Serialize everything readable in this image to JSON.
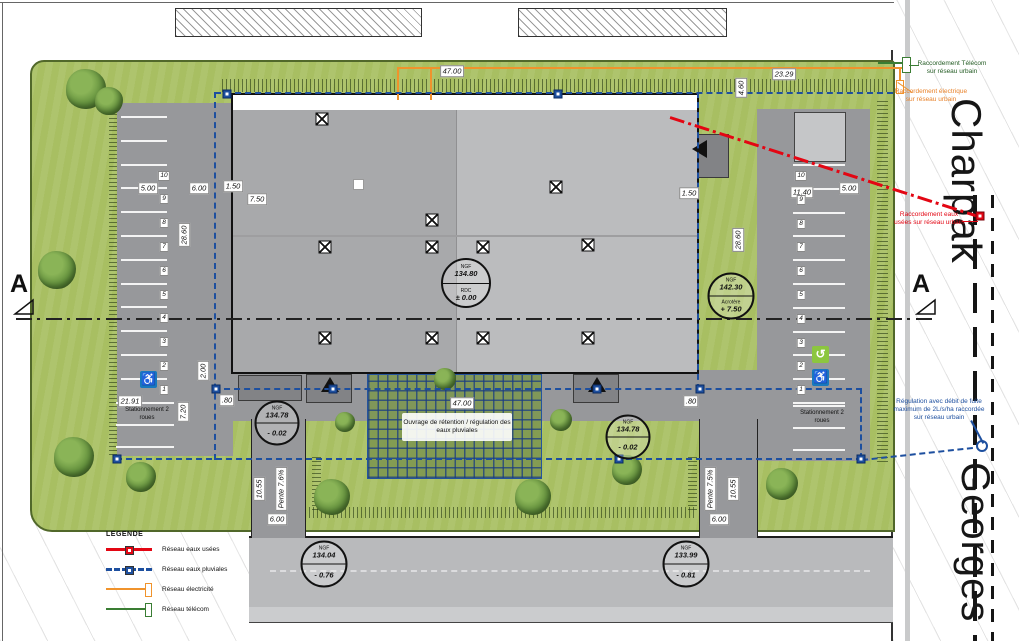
{
  "streets": {
    "main": "Charpak",
    "secondary": "Georges"
  },
  "section": {
    "label": "A"
  },
  "legend": {
    "title": "LEGENDE",
    "items": [
      {
        "label": "Réseau eaux usées"
      },
      {
        "label": "Réseau eaux pluviales"
      },
      {
        "label": "Réseau électricité"
      },
      {
        "label": "Réseau télécom"
      }
    ]
  },
  "annotations": {
    "telecom": "Raccordement Télécom sur réseau urbain",
    "electricite": "Raccordement électrique sur réseau urbain",
    "eaux_usees": "Raccordement eaux usées sur réseau urbain",
    "regulation": "Régulation avec débit de fuite maximum de 2L/s/ha raccordée sur réseau urbain",
    "retention": "Ouvrage de rétention / régulation des eaux pluviales"
  },
  "levels": {
    "rdc": {
      "ref": "NGF",
      "altitude": "134.80",
      "label": "RDC",
      "value": "± 0.00"
    },
    "acrotere": {
      "ref": "NGF",
      "altitude": "142.30",
      "label": "Acrotère",
      "value": "+ 7.50"
    },
    "parvis_ouest": {
      "ref": "NGF",
      "altitude": "134.78",
      "label": "",
      "value": "- 0.02"
    },
    "parvis_est": {
      "ref": "NGF",
      "altitude": "134.78",
      "label": "",
      "value": "- 0.02"
    },
    "voirie_ouest": {
      "ref": "NGF",
      "altitude": "134.04",
      "label": "",
      "value": "- 0.76"
    },
    "voirie_est": {
      "ref": "NGF",
      "altitude": "133.99",
      "label": "",
      "value": "- 0.81"
    }
  },
  "dimensions": {
    "building_width": "47.00",
    "north_east_width": "23.29",
    "north_east_depth": "4.60",
    "west_stall": "5.00",
    "west_aisle": "6.00",
    "west_strip": "1.50",
    "west_setback": "7.50",
    "west_length": "28.60",
    "east_strip": "1.50",
    "east_aisle": "11.40",
    "east_stall": "5.00",
    "east_length": "28.60",
    "south_width": "21.91",
    "south_depth": "7.20",
    "south_gap_west": ".80",
    "south_offset": "2.00",
    "south_gap_east": ".80",
    "retention_width": "47.00",
    "access_west_width": "6.00",
    "access_west_length": "10.55",
    "access_west_slope": "Pente 7.6%",
    "access_east_width": "6.00",
    "access_east_length": "10.55",
    "access_east_slope": "Pente 7.5%"
  },
  "parking": {
    "left_numbers": [
      "10",
      "9",
      "8",
      "7",
      "6",
      "5",
      "4",
      "3",
      "2",
      "1"
    ],
    "right_numbers": [
      "10",
      "9",
      "8",
      "7",
      "6",
      "5",
      "4",
      "3",
      "2",
      "1"
    ],
    "left_label": "Stationnement 2 roues",
    "right_label": "Stationnement 2 roues"
  },
  "icons": {
    "accessible": "♿",
    "ev": "↺"
  },
  "colors": {
    "eaux_usees": "#e30613",
    "eaux_pluviales": "#1d4f9f",
    "electricite": "#f0932c",
    "telecom": "#3a7d33",
    "grass": "#a8bf62",
    "pavement": "#97989b",
    "roof": "#b4b5b7"
  }
}
